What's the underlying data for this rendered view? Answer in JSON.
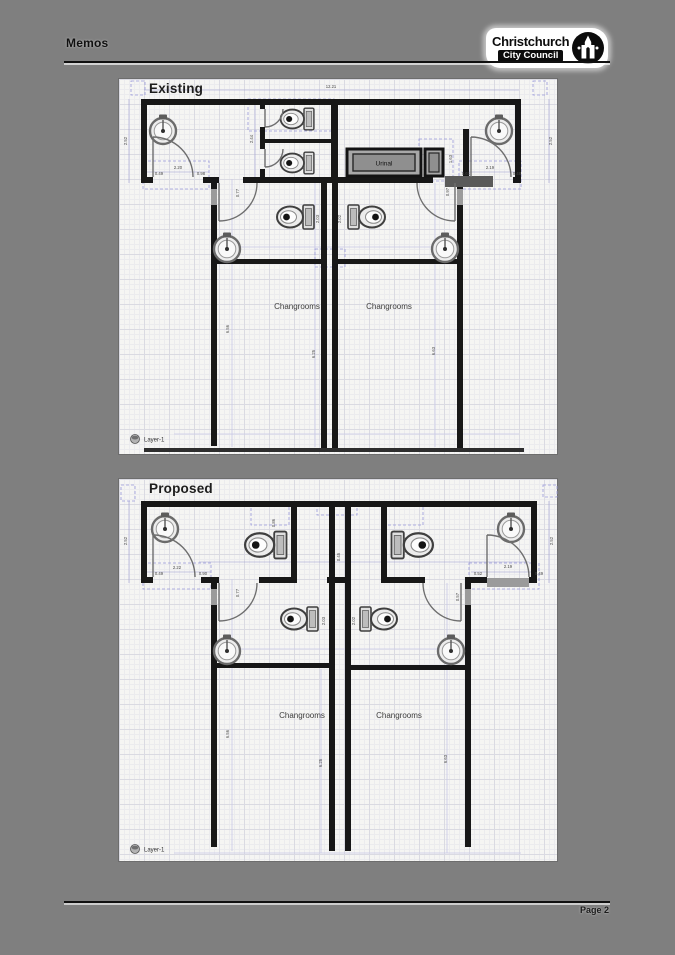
{
  "header": {
    "title": "Memos",
    "logo": {
      "line1": "Christchurch",
      "line2": "City Council"
    }
  },
  "footer": {
    "page_label": "Page 2"
  },
  "existing": {
    "title": "Existing",
    "layer_label": "Layer-1",
    "urinal_label": "Urinal",
    "changrooms_left": "Changrooms",
    "changrooms_right": "Changrooms",
    "dims": {
      "top_width": "12.21",
      "left_height": "2.52",
      "right_height": "2.52",
      "stall_depth": "2.44",
      "left_gap": "0.49",
      "left_door": "2.20",
      "left_clear": "0.98",
      "right_gap": "0.61",
      "right_door": "2.19",
      "right_clear": "0.48",
      "mid_left": "2.03",
      "mid_right": "2.02",
      "pass_left": "0.77",
      "pass_right": "0.97",
      "urinal_side": "1.63",
      "chg_wall": "6.56",
      "chg_left": "6.25",
      "chg_right": "6.63"
    }
  },
  "proposed": {
    "title": "Proposed",
    "layer_label": "Layer-1",
    "changrooms_left": "Changrooms",
    "changrooms_right": "Changrooms",
    "dims": {
      "left_height": "2.52",
      "right_height": "2.52",
      "left_gap": "0.49",
      "left_door": "2.22",
      "left_clear": "0.90",
      "right_gap": "0.52",
      "right_door": "2.19",
      "right_clear": "0.49",
      "toilet_offset": "0.86",
      "corridor": "0.45",
      "mid_left": "2.03",
      "mid_right": "2.02",
      "pass_left": "0.77",
      "pass_right": "0.57",
      "chg_wall": "6.56",
      "chg_left": "6.25",
      "chg_right": "6.63"
    }
  }
}
